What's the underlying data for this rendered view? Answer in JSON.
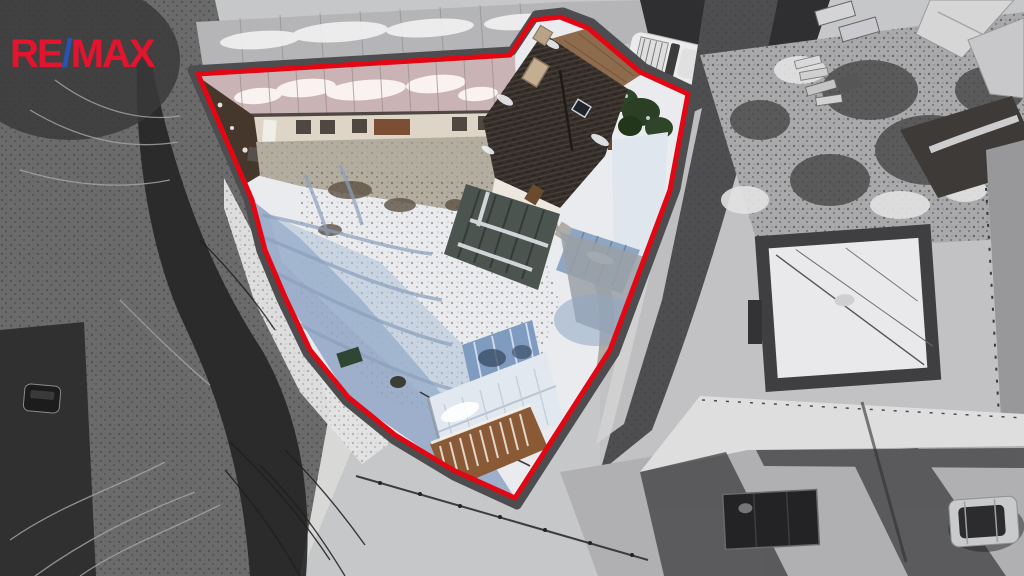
{
  "branding": {
    "logo_re": "RE",
    "logo_slash": "/",
    "logo_max": "MAX"
  },
  "colors": {
    "logo_red": "#E4132E",
    "logo_blue": "#2853B0",
    "boundary_red": "#E30613",
    "boundary_casing": "#4D4D4F",
    "snow_white": "#EAECEF",
    "shadow_blue": "#8FA5C3",
    "house_roof_brown": "#352E29",
    "metal_roof_blue": "#8FA6C2",
    "conifer_green": "#2F4529",
    "surroundings_grayscale": "#A9A9AB"
  }
}
